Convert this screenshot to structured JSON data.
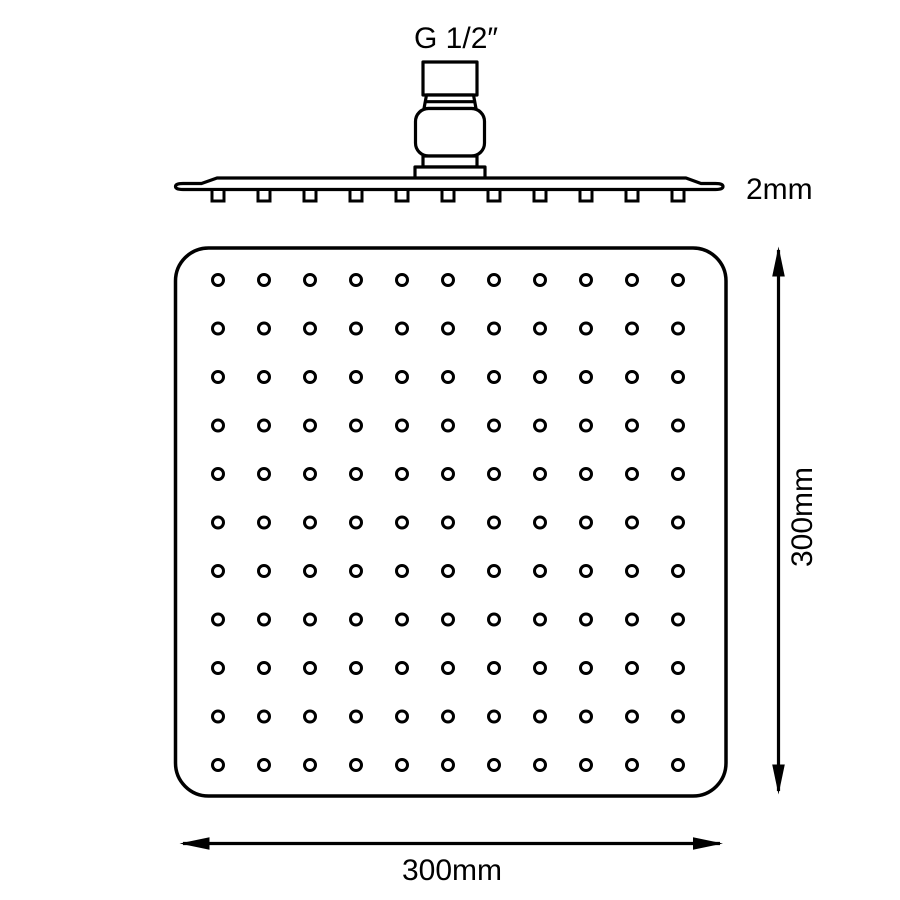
{
  "diagram": {
    "labels": {
      "thread_size": "G 1/2″",
      "plate_thickness": "2mm",
      "height_dimension": "300mm",
      "width_dimension": "300mm"
    },
    "nozzle_grid": {
      "rows": 11,
      "cols": 11,
      "total_holes": 121
    },
    "side_view": {
      "nozzle_tab_count": 11
    },
    "colors": {
      "line": "#000000",
      "background": "#ffffff"
    }
  }
}
